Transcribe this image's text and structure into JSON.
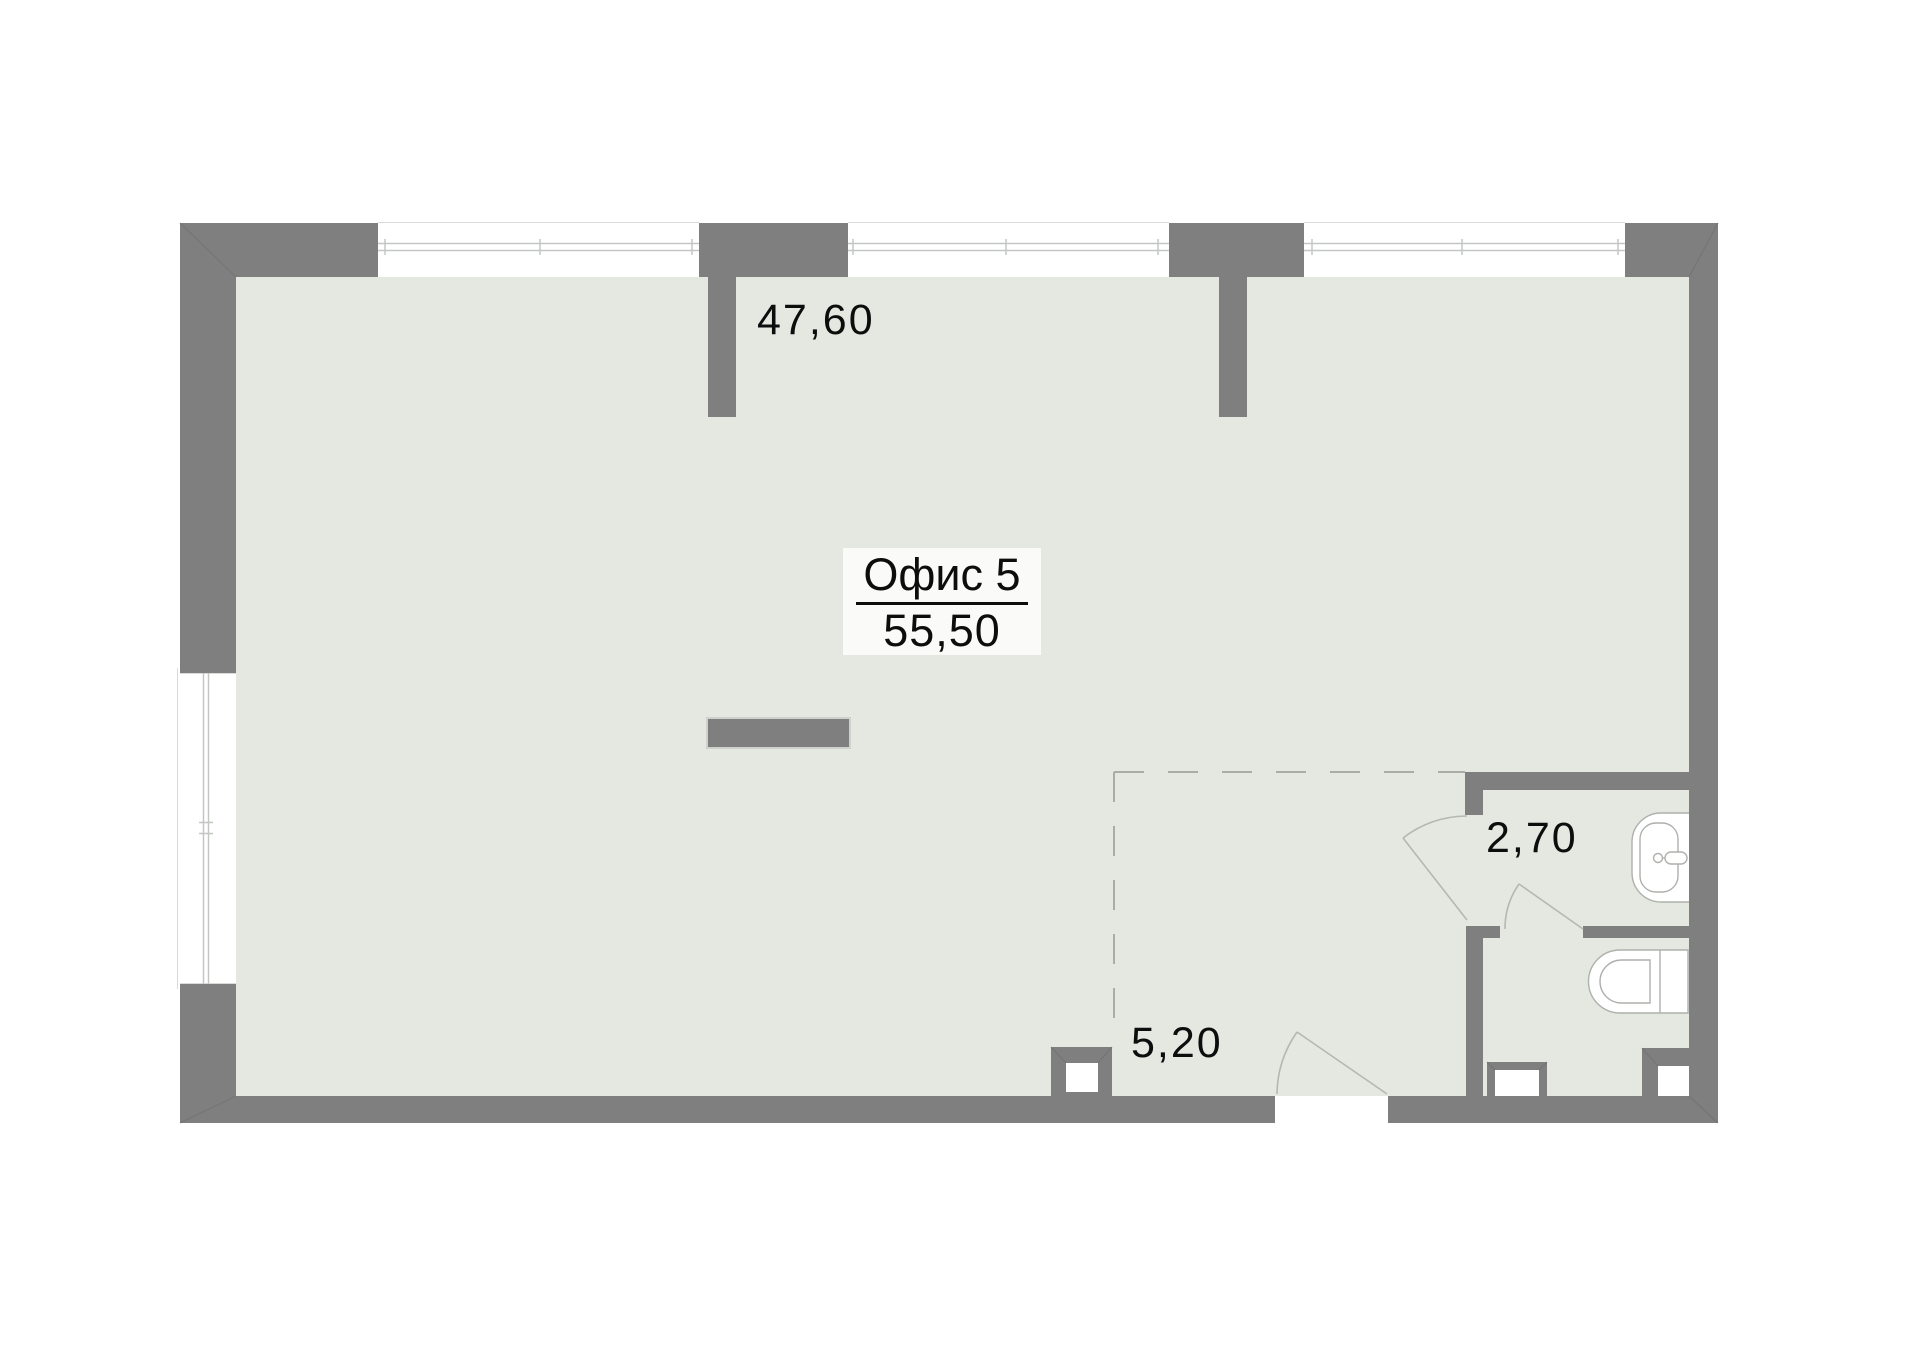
{
  "title_block": {
    "name": "Офис 5",
    "area": "55,50"
  },
  "room_labels": {
    "main_area": "47,60",
    "entry_area": "5,20",
    "bathroom_area": "2,70"
  },
  "icons": {
    "sink": "sink-icon",
    "toilet": "toilet-icon"
  },
  "colors": {
    "wall": "#7e7f7e",
    "floor": "#e4e8e1",
    "paper": "#ffffff",
    "glass": "#c3c7c2",
    "faint": "#d9dbd6",
    "door": "#b4b8b2",
    "dash": "#a8ada7",
    "fixture": "#aeb1ac",
    "text": "#0d0d0d",
    "label_box": "#fafbf8",
    "miter": "#6f706f"
  }
}
